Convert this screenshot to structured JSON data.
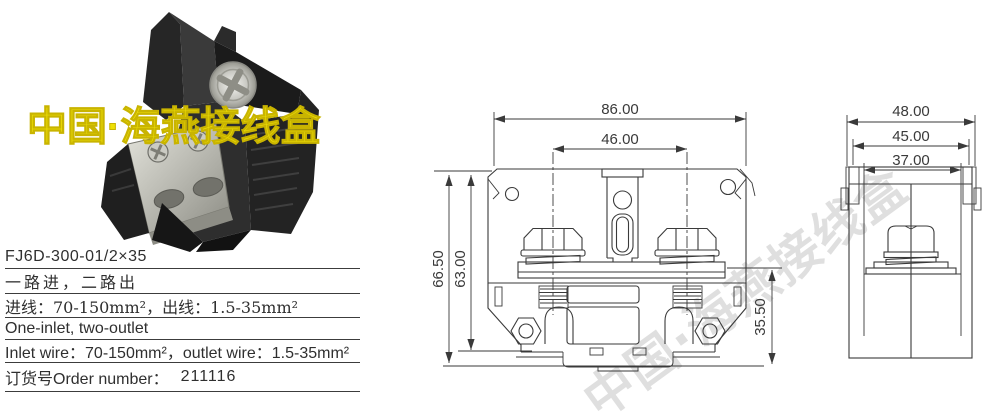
{
  "photo_watermark": {
    "text": "中国·海燕接线盒"
  },
  "diagonal_watermark": {
    "text": "中国·海燕接线盒"
  },
  "specs": {
    "model": "FJ6D-300-01/2×35",
    "route_cn": "一路进，二路出",
    "wires_cn": "进线：70-150mm²，出线：1.5-35mm²",
    "route_en": "One-inlet, two-outlet",
    "wires_en": "Inlet wire：70-150mm²，outlet wire：1.5-35mm²",
    "order_label": "订货号Order number：",
    "order_value": "211116"
  },
  "front_view": {
    "dim_top_width": "86.00",
    "dim_bolt_spacing": "46.00",
    "dim_total_height": "66.50",
    "dim_body_height": "63.00",
    "dim_lower_height": "35.50"
  },
  "side_view": {
    "dim_outer_width": "48.00",
    "dim_mid_width": "45.00",
    "dim_inner_width": "37.00"
  },
  "colors": {
    "drawing_line": "#3a3a3a",
    "watermark_yellow": "#eee005",
    "watermark_gray": "#c6c6c6",
    "text": "#2f2f2f"
  }
}
